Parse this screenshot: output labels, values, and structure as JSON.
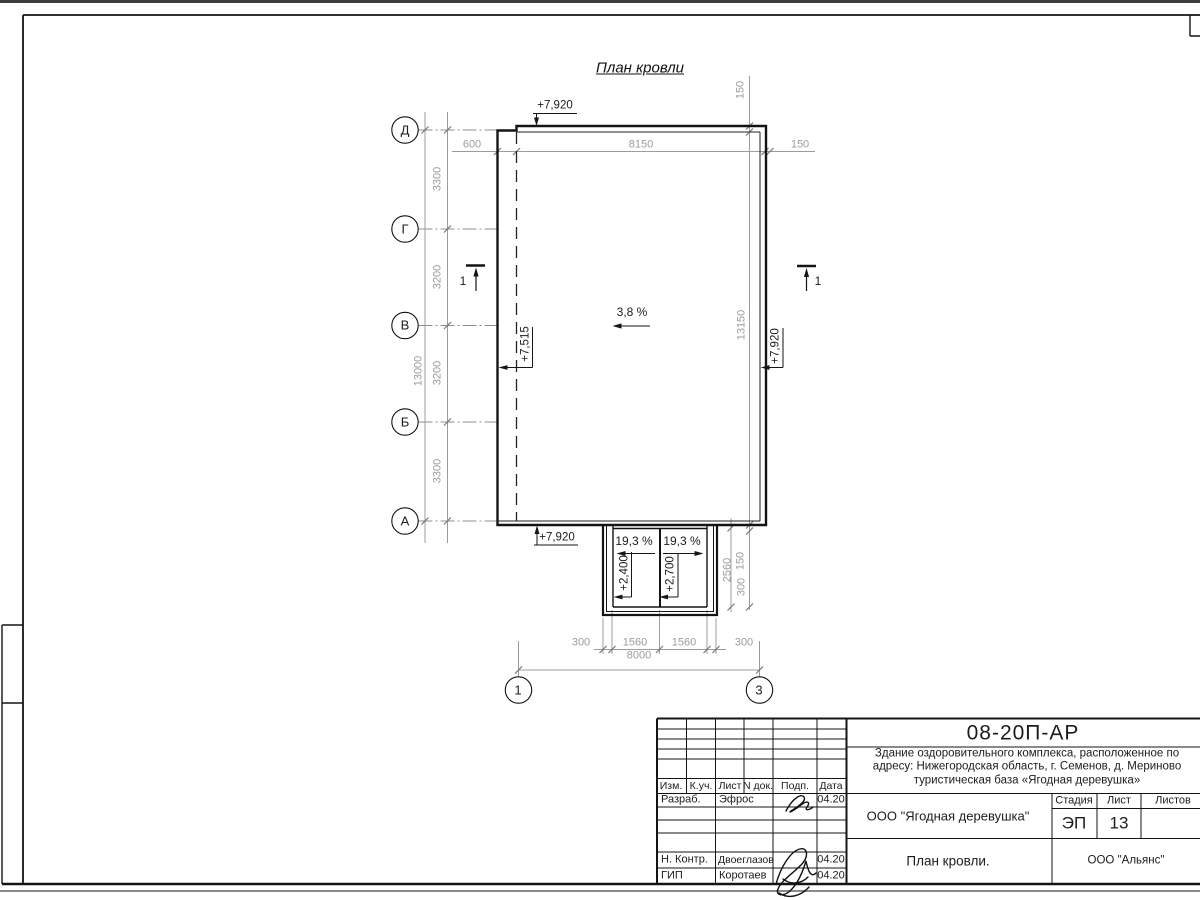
{
  "colors": {
    "line": "#1a1a1a",
    "dim_gray": "#9c9c9c",
    "paper": "#ffffff"
  },
  "plan": {
    "title": "План кровли",
    "axes_left": [
      "Д",
      "Г",
      "В",
      "Б",
      "А"
    ],
    "axes_bottom": [
      "1",
      "3"
    ],
    "section_label": "1",
    "dims": {
      "top": [
        "600",
        "8150",
        "150"
      ],
      "top_right": "150",
      "left_segments": [
        "3300",
        "3200",
        "3200",
        "3300"
      ],
      "left_total": "13000",
      "right_total": "13150",
      "porch_right": [
        "150",
        "2560",
        "300"
      ],
      "bottom_segments": [
        "300",
        "1560",
        "1560",
        "300"
      ],
      "bottom_total": "8000"
    },
    "elevations": {
      "top": "+7,920",
      "left": "+7,515",
      "right": "+7,920",
      "bottom": "+7,920",
      "porch_left": "+2,400",
      "porch_right": "+2,700"
    },
    "slopes": {
      "main": "3,8 %",
      "porch_left": "19,3 %",
      "porch_right": "19,3 %"
    }
  },
  "titleblock": {
    "code": "08-20П-АР",
    "project": [
      "Здание оздоровительного комплекса, расположенное по",
      "адресу: Нижегородская область, г. Семенов, д. Мериново",
      "туристическая база «Ягодная деревушка»"
    ],
    "header_cols": [
      "Изм.",
      "К.уч.",
      "Лист",
      "N док.",
      "Подп.",
      "Дата"
    ],
    "rows": [
      {
        "role": "Разраб.",
        "name": "Эфрос",
        "date": "04.20"
      },
      {
        "role": "Н. Контр.",
        "name": "Двоеглазов",
        "date": "04.20"
      },
      {
        "role": "ГИП",
        "name": "Коротаев",
        "date": "04.20"
      }
    ],
    "org": "ООО \"Ягодная деревушка\"",
    "stage_cols": [
      "Стадия",
      "Лист",
      "Листов"
    ],
    "stage": "ЭП",
    "sheet": "13",
    "doc_title": "План кровли.",
    "company": "ООО \"Альянс\""
  }
}
